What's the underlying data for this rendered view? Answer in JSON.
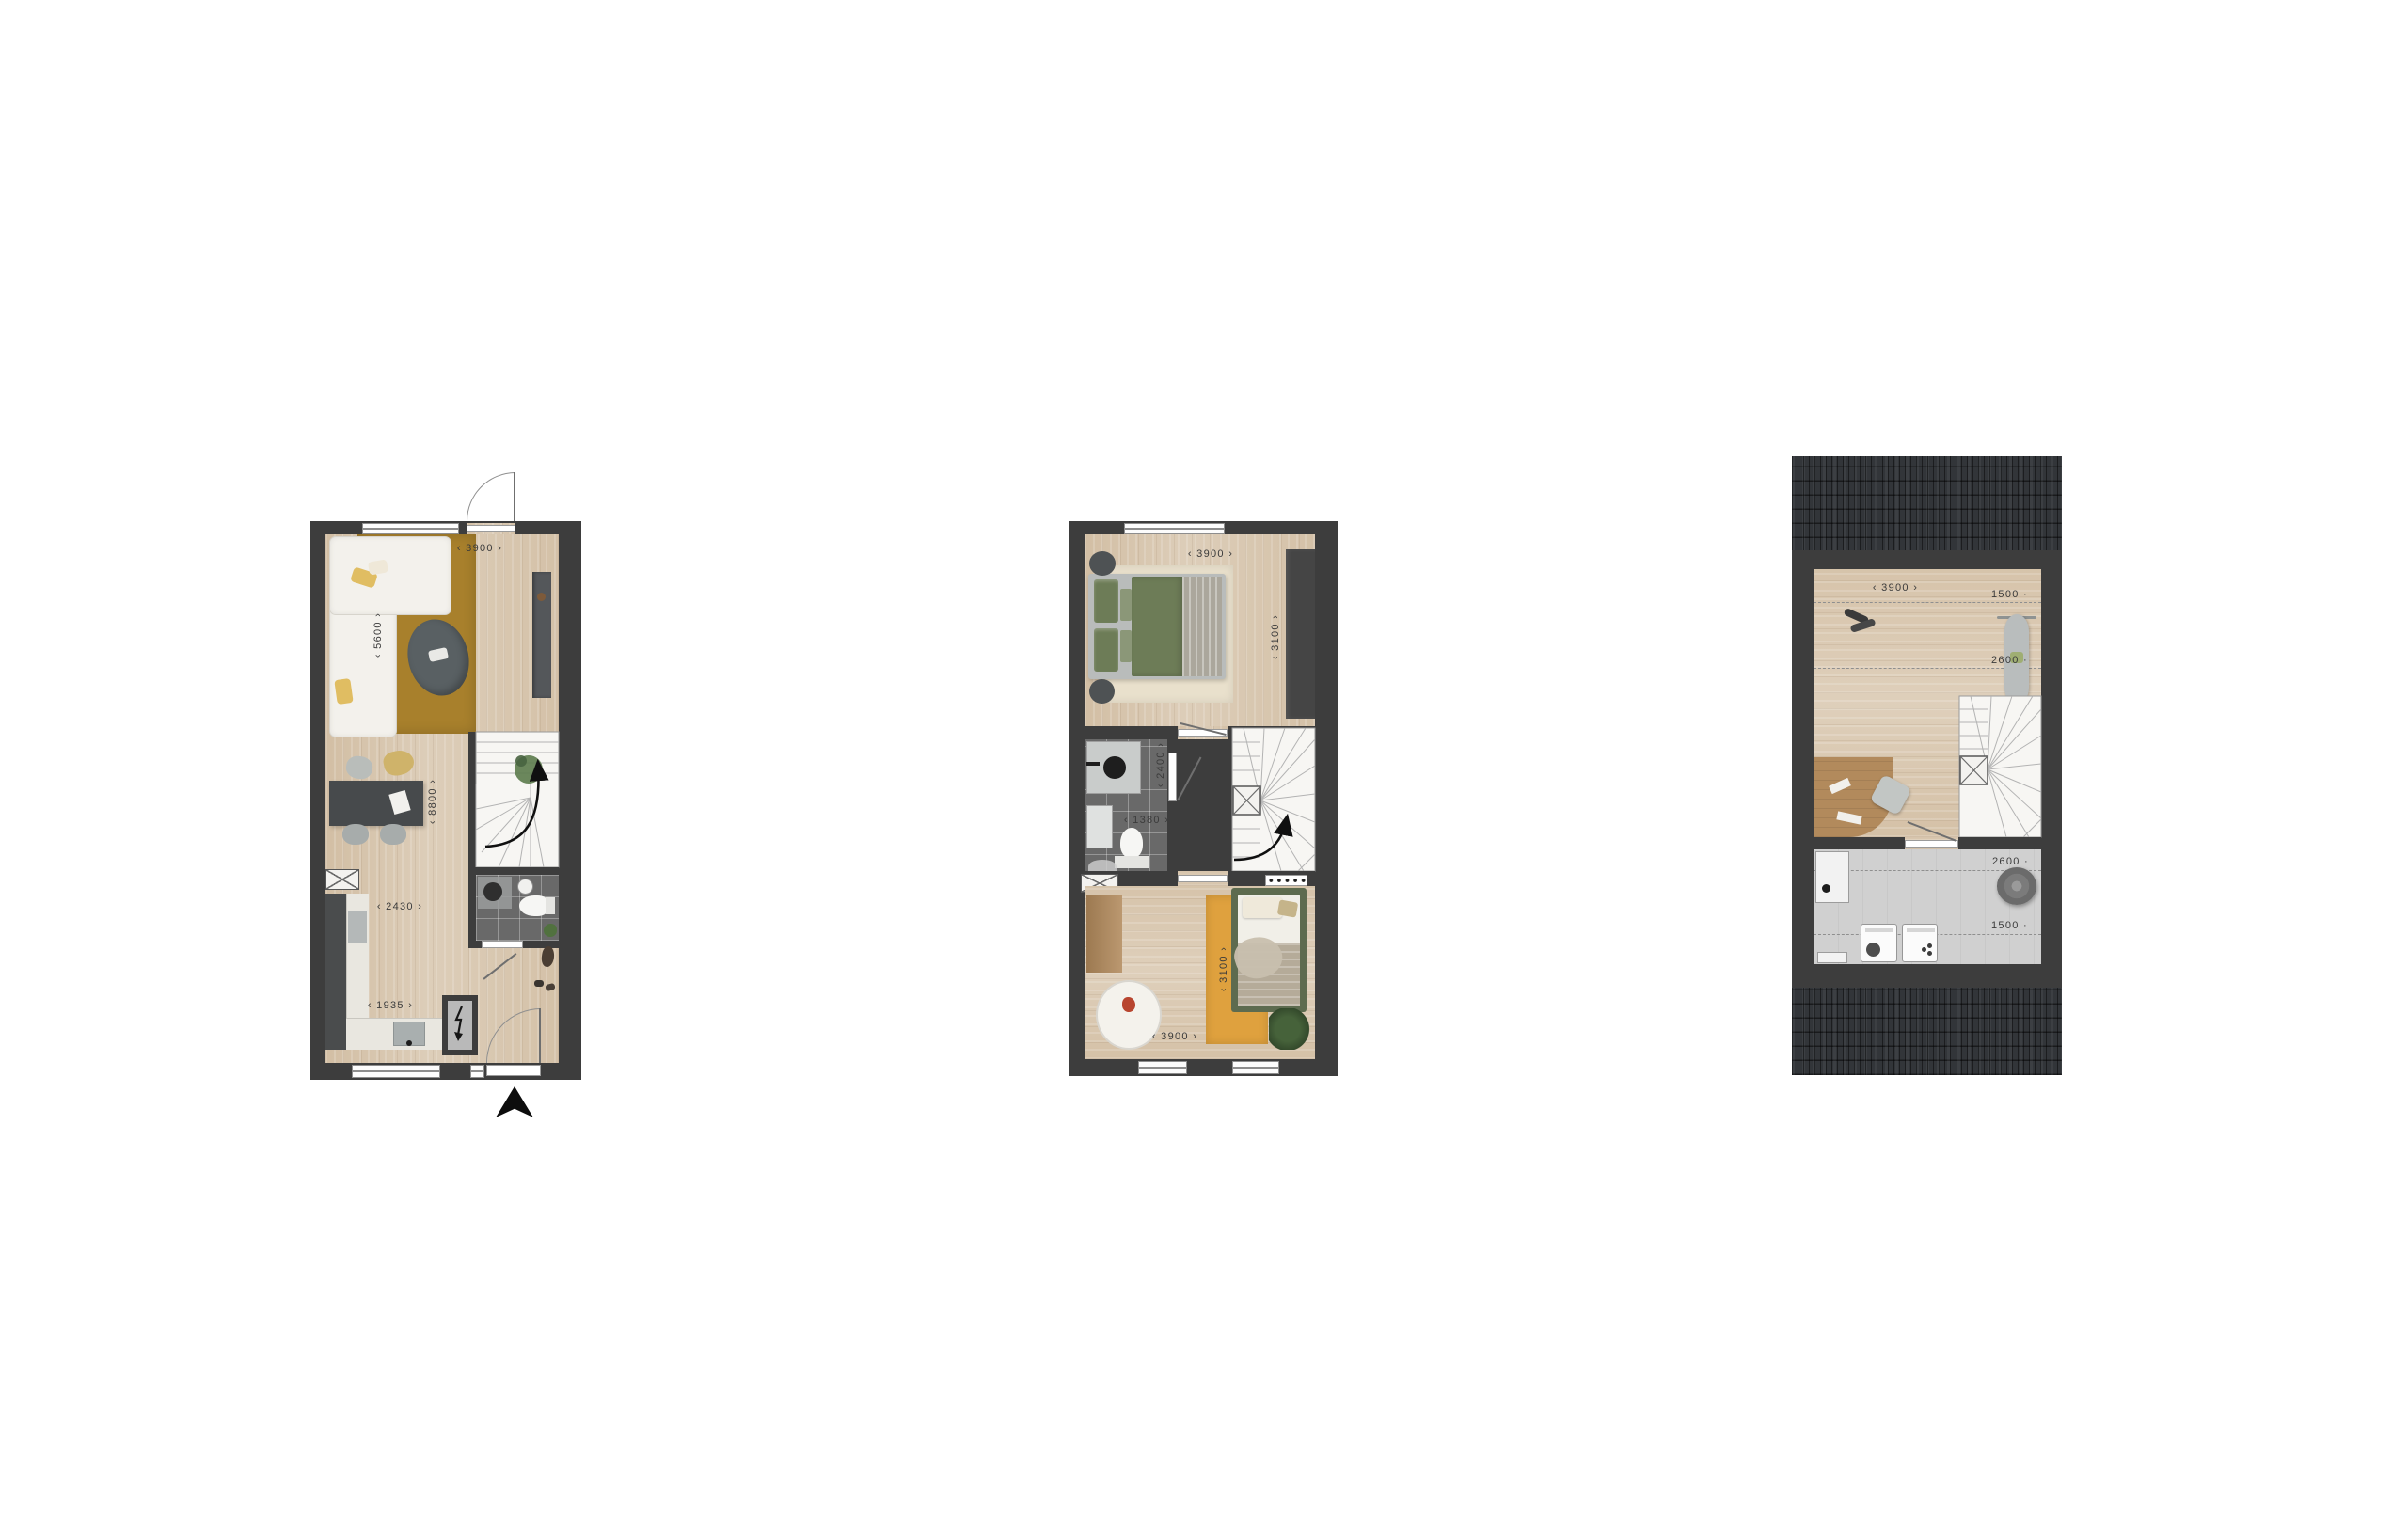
{
  "document": {
    "type": "floorplan-sheet",
    "background": "#ffffff"
  },
  "palette": {
    "wall": "#3d3d3d",
    "wood_floor": "#d9c8b1",
    "tile_floor": "#696969",
    "laundry_floor": "#d0d0d0",
    "roof": "#323539",
    "rug_mustard": "#a8802c",
    "rug_beige": "#e9e0cc",
    "rug_orange": "#dfa13e",
    "bed_green": "#6d7c57",
    "dimension_text": "#3b3b3b"
  },
  "icons": {
    "north_arrow": "solid-up-triangle",
    "stairs_direction": "curved-up-arrow",
    "meter_cupboard": "lightning-bolt",
    "shaft": "crossed-box"
  },
  "plans": [
    {
      "id": "ground-floor",
      "dims": {
        "top_width": "‹ 3900 ›",
        "living_depth": "‹ 5600 ›",
        "total_depth": "‹ 8800 ›",
        "kitchen_width": "‹ 2430 ›",
        "hall_width": "‹ 1935 ›"
      }
    },
    {
      "id": "first-floor",
      "dims": {
        "top_width": "‹ 3900 ›",
        "bedroom1_depth": "‹ 3100 ›",
        "bathroom_depth": "‹ 2400 ›",
        "bathroom_width": "‹ 1380 ›",
        "bedroom2_depth": "‹ 3100 ›",
        "bottom_width": "‹ 3900 ›"
      }
    },
    {
      "id": "second-floor",
      "dims": {
        "top_width": "‹ 3900 ›",
        "front_headroom_low": "1500 ·",
        "front_headroom_high": "2600 ·",
        "rear_headroom_high": "2600 ·",
        "rear_headroom_low": "1500 ·"
      }
    }
  ]
}
